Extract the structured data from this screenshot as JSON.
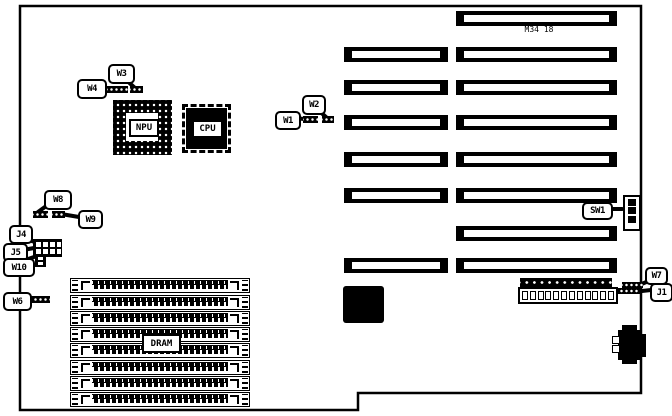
{
  "diagram": {
    "part_number": "M34 18",
    "chips": {
      "npu": "NPU",
      "cpu": "CPU"
    },
    "memory": {
      "label": "DRAM",
      "slot_count": 8
    },
    "expansion": {
      "left_slot_count": 6,
      "right_slot_count": 8
    },
    "power_connector": {
      "pin_count": 12
    },
    "dip_switch": {
      "segment_count": 3
    },
    "colors": {
      "ink": "#000000",
      "paper": "#ffffff"
    },
    "callouts": [
      {
        "id": "W3",
        "label": "W3"
      },
      {
        "id": "W4",
        "label": "W4"
      },
      {
        "id": "W2",
        "label": "W2"
      },
      {
        "id": "W1",
        "label": "W1"
      },
      {
        "id": "W8",
        "label": "W8"
      },
      {
        "id": "W9",
        "label": "W9"
      },
      {
        "id": "J4",
        "label": "J4"
      },
      {
        "id": "J5",
        "label": "J5"
      },
      {
        "id": "W10",
        "label": "W10"
      },
      {
        "id": "W6",
        "label": "W6"
      },
      {
        "id": "SW1",
        "label": "SW1"
      },
      {
        "id": "W7",
        "label": "W7"
      },
      {
        "id": "J1",
        "label": "J1"
      }
    ]
  }
}
